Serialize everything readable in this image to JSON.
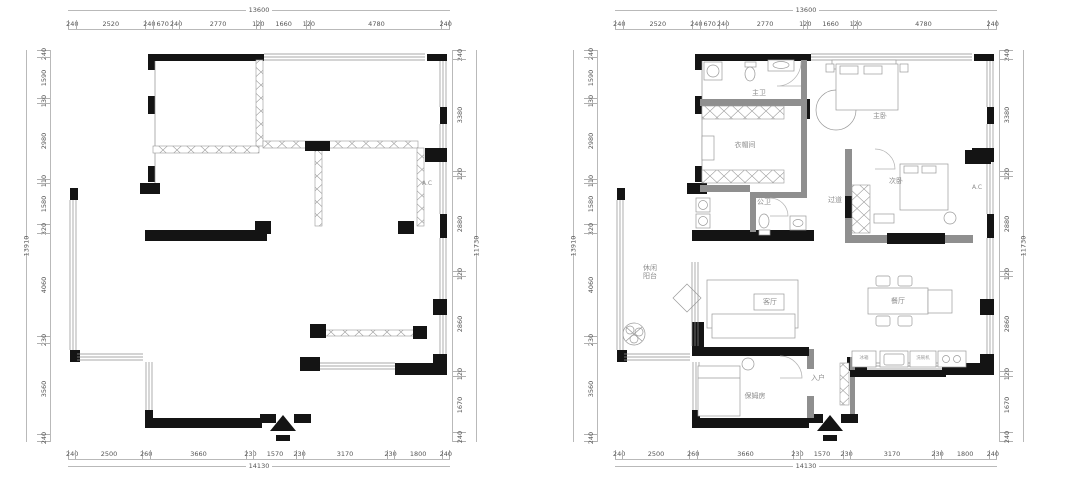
{
  "document": {
    "type": "apartment-floor-plans",
    "left_plan_role": "original structural plan",
    "right_plan_role": "furnished layout plan"
  },
  "colors": {
    "wall_black": "#141414",
    "wall_gray": "#8f8f8f",
    "line_gray": "#9a9a9a",
    "dim_text": "#555555",
    "label_text": "#8d8d8d",
    "background": "#ffffff"
  },
  "dimensions": {
    "top": {
      "total": "13600",
      "segments": [
        {
          "t": "240",
          "f": 240
        },
        {
          "t": "2520",
          "f": 2520
        },
        {
          "t": "240",
          "f": 240
        },
        {
          "t": "670",
          "f": 670
        },
        {
          "t": "240",
          "f": 240
        },
        {
          "t": "2770",
          "f": 2770
        },
        {
          "t": "120",
          "f": 120
        },
        {
          "t": "1660",
          "f": 1660
        },
        {
          "t": "120",
          "f": 120
        },
        {
          "t": "4780",
          "f": 4780
        },
        {
          "t": "240",
          "f": 240
        }
      ]
    },
    "bottom": {
      "total": "14130",
      "segments": [
        {
          "t": "240",
          "f": 240
        },
        {
          "t": "2500",
          "f": 2500
        },
        {
          "t": "260",
          "f": 260
        },
        {
          "t": "3660",
          "f": 3660
        },
        {
          "t": "230",
          "f": 230
        },
        {
          "t": "1570",
          "f": 1570
        },
        {
          "t": "230",
          "f": 230
        },
        {
          "t": "3170",
          "f": 3170
        },
        {
          "t": "230",
          "f": 230
        },
        {
          "t": "1800",
          "f": 1800
        },
        {
          "t": "240",
          "f": 240
        }
      ]
    },
    "left": {
      "total": "13910",
      "segments": [
        {
          "t": "240",
          "f": 240
        },
        {
          "t": "1590",
          "f": 1590
        },
        {
          "t": "130",
          "f": 130
        },
        {
          "t": "2980",
          "f": 2980
        },
        {
          "t": "110",
          "f": 110
        },
        {
          "t": "1580",
          "f": 1580
        },
        {
          "t": "320",
          "f": 320
        },
        {
          "t": "4060",
          "f": 4060
        },
        {
          "t": "230",
          "f": 230
        },
        {
          "t": "3560",
          "f": 3560
        },
        {
          "t": "240",
          "f": 240
        }
      ]
    },
    "right": {
      "total": "11730",
      "segments": [
        {
          "t": "240",
          "f": 240
        },
        {
          "t": "3380",
          "f": 3380
        },
        {
          "t": "120",
          "f": 120
        },
        {
          "t": "2880",
          "f": 2880
        },
        {
          "t": "120",
          "f": 120
        },
        {
          "t": "2860",
          "f": 2860
        },
        {
          "t": "120",
          "f": 120
        },
        {
          "t": "1670",
          "f": 1670
        },
        {
          "t": "240",
          "f": 240
        }
      ]
    }
  },
  "rooms": {
    "master_bath": "主卫",
    "master_bedroom": "主卧",
    "cloakroom": "衣帽间",
    "second_bedroom": "次卧",
    "hallway": "过道",
    "guest_bath": "公卫",
    "living_room": "客厅",
    "dining_room": "餐厅",
    "balcony_line1": "休闲",
    "balcony_line2": "阳台",
    "nanny_room": "保姆房",
    "entry": "入户",
    "ac": "A.C",
    "fridge": "冰箱",
    "dishwasher": "洗碗机"
  }
}
